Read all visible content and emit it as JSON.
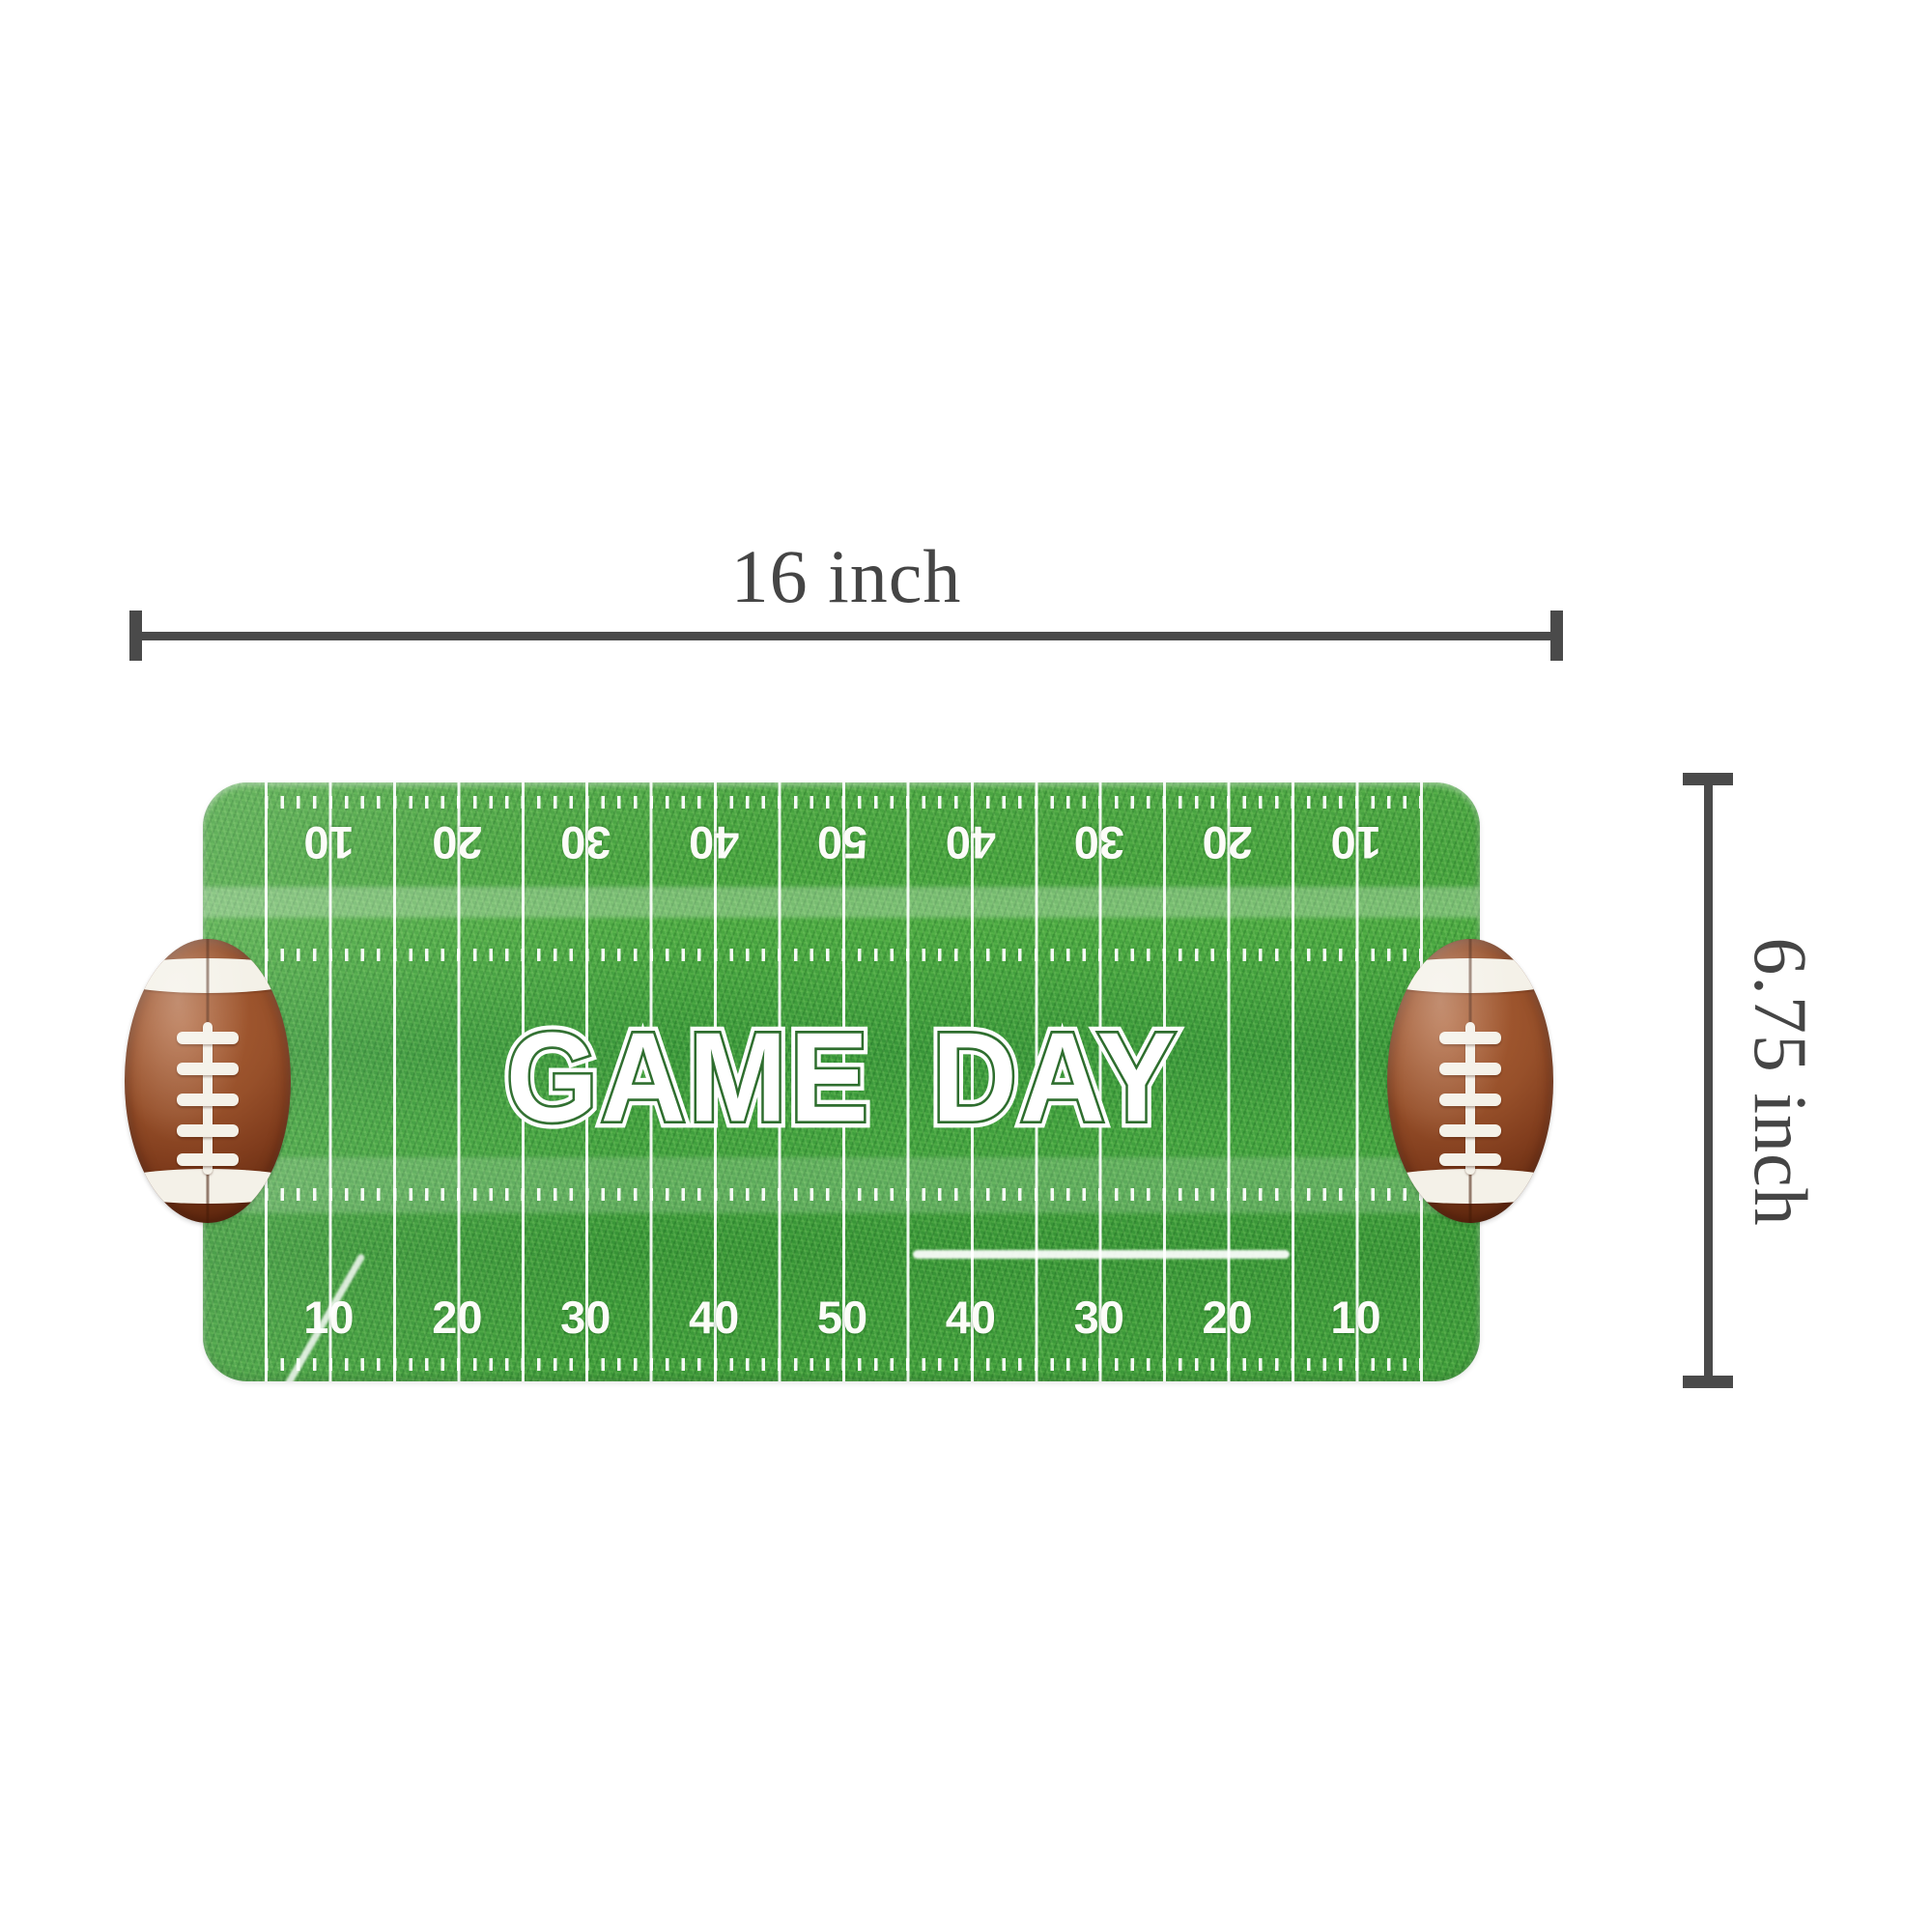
{
  "dimension_annotations": {
    "width": {
      "label": "16 inch"
    },
    "height": {
      "label": "6.75 inch"
    },
    "line_color": "#4a4a4a",
    "text_color": "#454545"
  },
  "tray": {
    "title": "GAME DAY",
    "yard_numbers_top": [
      "10",
      "20",
      "30",
      "40",
      "50",
      "40",
      "30",
      "20",
      "10"
    ],
    "yard_numbers_bottom": [
      "10",
      "20",
      "30",
      "40",
      "50",
      "40",
      "30",
      "20",
      "10"
    ],
    "colors": {
      "grass_green": "#3f9c3a",
      "yard_line_white": "#ffffff",
      "title_keyline_green": "#2e6e2e",
      "football_brown": "#8a4423",
      "lace_white": "#f4f1e8"
    }
  }
}
